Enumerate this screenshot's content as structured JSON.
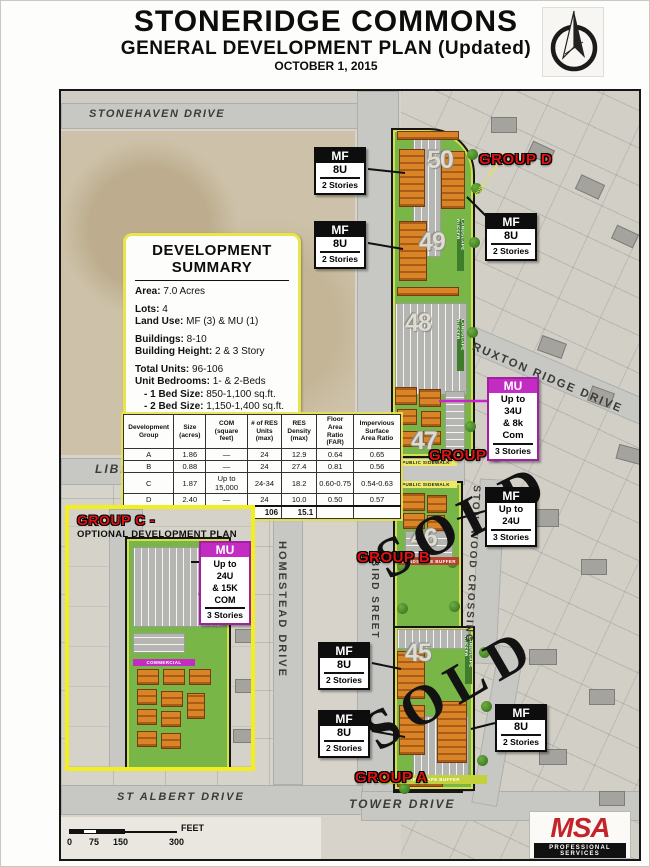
{
  "title": {
    "main": "STONERIDGE COMMONS",
    "sub": "GENERAL DEVELOPMENT PLAN (Updated)",
    "date": "OCTOBER 1, 2015"
  },
  "summary": {
    "heading": "DEVELOPMENT SUMMARY",
    "items": [
      {
        "label": "Area:",
        "value": "7.0 Acres"
      },
      {
        "label": "Lots:",
        "value": "4"
      },
      {
        "label": "Land Use:",
        "value": "MF (3) & MU (1)"
      },
      {
        "label": "Buildings:",
        "value": "8-10"
      },
      {
        "label": "Building Height:",
        "value": "2 & 3 Story"
      },
      {
        "label": "Total Units:",
        "value": "96-106"
      },
      {
        "label": "Unit Bedrooms:",
        "value": "1- & 2-Beds"
      },
      {
        "label": "- 1 Bed Size:",
        "value": "850-1,100 sq.ft."
      },
      {
        "label": "- 2 Bed Size:",
        "value": "1,150-1,400 sq.ft."
      }
    ]
  },
  "table": {
    "headers": [
      "Development\nGroup",
      "Size\n(acres)",
      "COM\n(square feet)",
      "# of RES\nUnits\n(max)",
      "RES\nDensity\n(max)",
      "Floor Area\nRatio\n(FAR)",
      "Impervious\nSurface\nArea Ratio"
    ],
    "rows": [
      [
        "A",
        "1.86",
        "—",
        "24",
        "12.9",
        "0.64",
        "0.65"
      ],
      [
        "B",
        "0.88",
        "—",
        "24",
        "27.4",
        "0.81",
        "0.56"
      ],
      [
        "C",
        "1.87",
        "Up to 15,000",
        "24-34",
        "18.2",
        "0.60-0.75",
        "0.54-0.63"
      ],
      [
        "D",
        "2.40",
        "—",
        "24",
        "10.0",
        "0.50",
        "0.57"
      ]
    ],
    "total": [
      "TOTAL",
      "7.001",
      "8,000",
      "106",
      "15.1"
    ]
  },
  "map": {
    "streets": {
      "stonehaven": "STONEHAVEN DRIVE",
      "liberty": "LIBERTY BOULEVARD",
      "homestead": "HOMESTEAD DRIVE",
      "bird": "BIRD SREET",
      "ruxton_ridge": "RUXTON RIDGE DRIVE",
      "stonewood": "STONEWOOD CROSSING",
      "st_albert": "ST ALBERT DRIVE",
      "tower": "TOWER DRIVE"
    },
    "lots": {
      "l50": "50",
      "l49": "49",
      "l48": "48",
      "l47": "47",
      "l46": "46",
      "l45": "45"
    },
    "groups": {
      "a": "GROUP A",
      "b": "GROUP B",
      "c": "GROUP C",
      "d": "GROUP D"
    },
    "sold": "SOLD",
    "small_labels": {
      "public_sidewalk": "PUBLIC SIDEWALK",
      "landscape_buffer": "LANDSCAPE BUFFER",
      "commercial": "COMMERCIAL"
    },
    "unit_labels": {
      "mf_8u": {
        "type": "MF",
        "units": "8U",
        "stories": "2 Stories"
      },
      "mf_24u": {
        "type": "MF",
        "units": "Up to 24U",
        "stories": "3 Stories"
      },
      "mu_34u": {
        "type": "MU",
        "units": "Up to 34U\n& 8k Com",
        "stories": "3 Stories"
      },
      "mu_24u": {
        "type": "MU",
        "units": "Up to 24U\n& 15K COM",
        "stories": "3 Stories"
      }
    }
  },
  "inset": {
    "group_title": "GROUP C -",
    "subtitle": "OPTIONAL DEVELOPMENT PLAN",
    "street": "RUXTON"
  },
  "scale_bar": {
    "ticks": [
      "0",
      "75",
      "150",
      "300"
    ],
    "unit": "FEET"
  },
  "msa_logo": {
    "name": "MSA",
    "tagline": "PROFESSIONAL SERVICES"
  },
  "colors": {
    "group_red": "#e01212",
    "mu_magenta": "#c32cc3",
    "site_green": "#79b648",
    "building_orange": "#d98427",
    "border_yellow": "#f2ee1f",
    "msa_red": "#c4232a"
  }
}
